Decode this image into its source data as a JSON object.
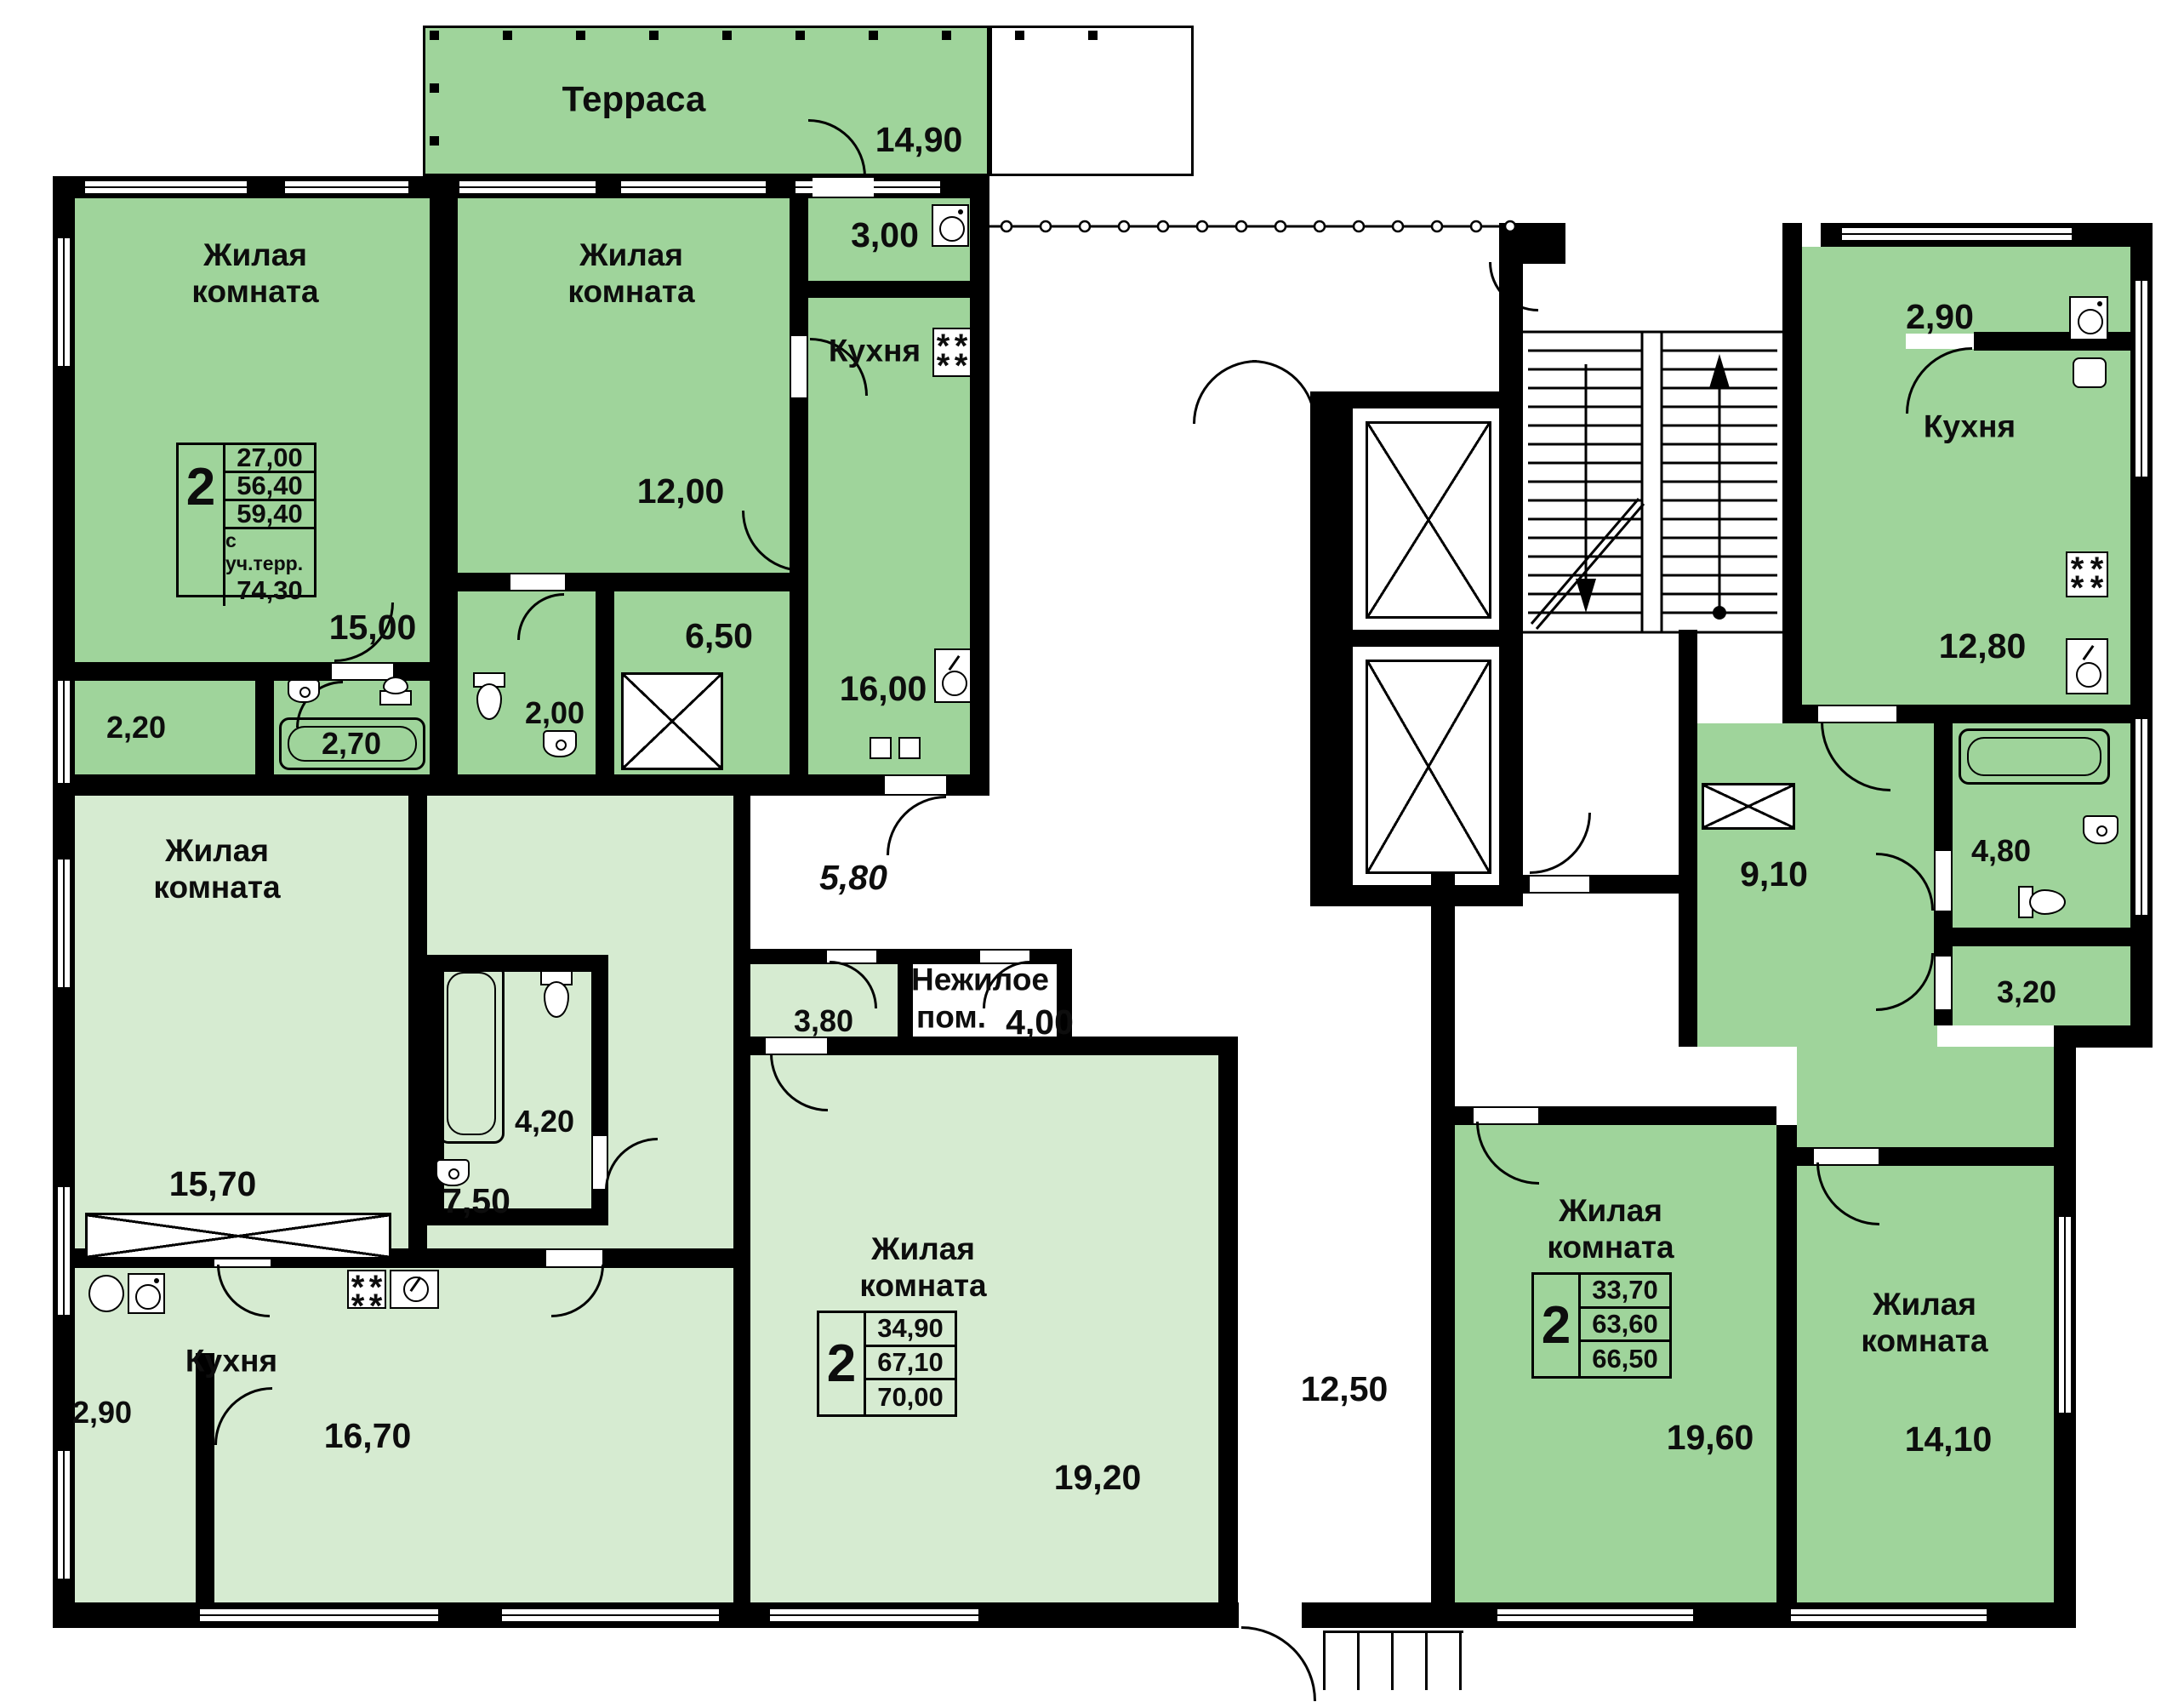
{
  "terrace": {
    "label": "Терраса",
    "area": "14,90"
  },
  "a1": {
    "sum": {
      "n": "2",
      "s1": "27,00",
      "s2": "56,40",
      "s3": "59,40",
      "note": "с уч.терр.",
      "s4": "74,30"
    },
    "room1": "Жилая комната",
    "room1_area": "15,00",
    "room2": "Жилая комната",
    "room2_area": "12,00",
    "kitchen": "Кухня",
    "kitchen_area": "16,00",
    "entry_area": "3,00",
    "closet_area": "2,20",
    "bath_area": "2,70",
    "wc_area": "2,00",
    "hall_area": "6,50"
  },
  "a2": {
    "sum": {
      "n": "2",
      "s1": "34,90",
      "s2": "67,10",
      "s3": "70,00"
    },
    "room1": "Жилая комната",
    "room1_area": "15,70",
    "room2": "Жилая комната",
    "room2_area": "19,20",
    "kitchen": "Кухня",
    "kitchen_area": "16,70",
    "bath_area": "4,20",
    "hall_area": "7,50",
    "entry_area": "2,90",
    "storage_area": "3,80"
  },
  "a3": {
    "sum": {
      "n": "2",
      "s1": "33,70",
      "s2": "63,60",
      "s3": "66,50"
    },
    "room1": "Жилая комната",
    "room1_area": "19,60",
    "room2": "Жилая комната",
    "room2_area": "14,10",
    "kitchen": "Кухня",
    "kitchen_area": "12,80",
    "entry_area": "2,90",
    "hall_area": "9,10",
    "bath_area": "4,80",
    "wc_area": "3,20"
  },
  "common": {
    "corr1": "5,80",
    "corr2": "12,50",
    "nonres1": "Нежилое",
    "nonres2": "пом.",
    "nonres_area": "4,00"
  }
}
